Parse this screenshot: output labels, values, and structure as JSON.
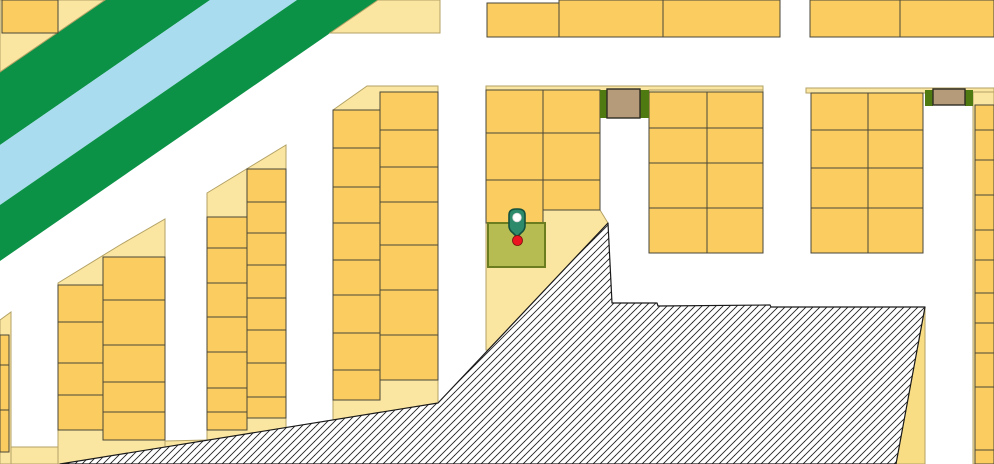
{
  "map": {
    "width": 994,
    "height": 464,
    "palette": {
      "road": "#ffffff",
      "block_cream": "#FBE6A1",
      "block_cream_deep": "#F9DD85",
      "block_stroke": "#B3A266",
      "parcel_fill": "#FBCC5F",
      "parcel_stroke": "#4A4638",
      "river_green": "#0B9247",
      "river_blue": "#A8DCEE",
      "hatch_line": "#222222",
      "hatch_stroke": "#1a1a1a",
      "building_brown": "#B59B79",
      "building_brown_stroke": "#2E2C24",
      "landmark_green": "#4F7A12",
      "selected_fill": "#B6BC52",
      "selected_stroke": "#6B7D1F",
      "pin_fill": "#2D8A6B",
      "pin_stroke": "#14503E",
      "pin_dot_fill": "#ffffff",
      "pin_dot_stroke": "#DADADA",
      "marker_red": "#EC1420",
      "marker_red_stroke": "#7A100F"
    },
    "river_bands": [
      {
        "name": "river-bank-upper",
        "fill": "river_green",
        "points": [
          [
            105,
            0
          ],
          [
            210,
            0
          ],
          [
            0,
            145
          ],
          [
            0,
            72
          ]
        ]
      },
      {
        "name": "river-water",
        "fill": "river_blue",
        "points": [
          [
            210,
            0
          ],
          [
            297,
            0
          ],
          [
            0,
            205
          ],
          [
            0,
            145
          ]
        ]
      },
      {
        "name": "river-bank-lower",
        "fill": "river_green",
        "points": [
          [
            297,
            0
          ],
          [
            378,
            0
          ],
          [
            0,
            261
          ],
          [
            0,
            205
          ]
        ]
      }
    ],
    "blocks": [
      {
        "name": "city-block-topleft",
        "fill": "block_cream",
        "points": [
          [
            0,
            0
          ],
          [
            105,
            0
          ],
          [
            0,
            72
          ]
        ]
      },
      {
        "name": "city-block-topmiddle",
        "fill": "block_cream",
        "points": [
          [
            378,
            0
          ],
          [
            440,
            0
          ],
          [
            440,
            33
          ],
          [
            330,
            33
          ]
        ]
      },
      {
        "name": "city-block-left-sliver",
        "fill": "block_cream",
        "points": [
          [
            0,
            320
          ],
          [
            11,
            312
          ],
          [
            11,
            464
          ],
          [
            0,
            464
          ]
        ]
      },
      {
        "name": "city-block-l2",
        "fill": "block_cream",
        "points": [
          [
            58,
            283
          ],
          [
            120,
            245
          ],
          [
            165,
            219
          ],
          [
            165,
            464
          ],
          [
            58,
            464
          ]
        ]
      },
      {
        "name": "city-block-l3",
        "fill": "block_cream",
        "points": [
          [
            207,
            193
          ],
          [
            286,
            145
          ],
          [
            286,
            464
          ],
          [
            207,
            464
          ]
        ]
      },
      {
        "name": "city-block-l4",
        "fill": "block_cream",
        "points": [
          [
            333,
            110
          ],
          [
            367,
            86
          ],
          [
            438,
            86
          ],
          [
            438,
            464
          ],
          [
            333,
            464
          ]
        ]
      },
      {
        "name": "city-block-center",
        "fill": "block_cream",
        "points": [
          [
            486,
            88
          ],
          [
            600,
            88
          ],
          [
            600,
            210
          ],
          [
            608,
            223
          ],
          [
            488,
            350
          ],
          [
            486,
            350
          ]
        ]
      },
      {
        "name": "city-block-center-strip",
        "fill": "block_cream",
        "points": [
          [
            486,
            86
          ],
          [
            763,
            86
          ],
          [
            763,
            91
          ],
          [
            486,
            91
          ]
        ]
      },
      {
        "name": "city-block-r1",
        "fill": "block_cream",
        "points": [
          [
            649,
            90
          ],
          [
            763,
            90
          ],
          [
            763,
            253
          ],
          [
            649,
            253
          ]
        ]
      },
      {
        "name": "city-block-r2-strip",
        "fill": "block_cream",
        "points": [
          [
            806,
            88
          ],
          [
            994,
            88
          ],
          [
            994,
            93
          ],
          [
            806,
            93
          ]
        ]
      },
      {
        "name": "city-block-r2",
        "fill": "block_cream",
        "points": [
          [
            811,
            93
          ],
          [
            923,
            93
          ],
          [
            923,
            253
          ],
          [
            811,
            253
          ]
        ]
      },
      {
        "name": "city-block-right-strip",
        "fill": "block_cream",
        "points": [
          [
            973,
            92
          ],
          [
            994,
            92
          ],
          [
            994,
            464
          ],
          [
            973,
            464
          ]
        ]
      },
      {
        "name": "city-block-se-wedge",
        "fill": "block_cream_deep",
        "points": [
          [
            925,
            307
          ],
          [
            925,
            464
          ],
          [
            896,
            464
          ]
        ]
      },
      {
        "name": "city-block-bottom-sliver-a",
        "fill": "block_cream",
        "points": [
          [
            11,
            447
          ],
          [
            58,
            447
          ],
          [
            58,
            464
          ],
          [
            11,
            464
          ]
        ]
      },
      {
        "name": "city-block-bottom-sliver-b",
        "fill": "block_cream",
        "points": [
          [
            165,
            441
          ],
          [
            207,
            440
          ],
          [
            165,
            448
          ]
        ]
      }
    ],
    "parcel_columns": [
      {
        "name": "parcel-col-topleft-corner",
        "x": 2,
        "w": 56,
        "rows": [
          [
            0,
            33
          ]
        ]
      },
      {
        "name": "parcel-col-top-1",
        "x": 487,
        "w": 72,
        "rows": [
          [
            3,
            37
          ]
        ]
      },
      {
        "name": "parcel-col-top-2",
        "x": 559,
        "w": 104,
        "rows": [
          [
            0,
            37
          ]
        ]
      },
      {
        "name": "parcel-col-top-3",
        "x": 663,
        "w": 117,
        "rows": [
          [
            0,
            37
          ]
        ]
      },
      {
        "name": "parcel-col-top-4",
        "x": 810,
        "w": 90,
        "rows": [
          [
            0,
            37
          ]
        ]
      },
      {
        "name": "parcel-col-top-5",
        "x": 900,
        "w": 94,
        "rows": [
          [
            0,
            37
          ]
        ]
      },
      {
        "name": "parcel-col-l1",
        "x": 0,
        "w": 9,
        "rows": [
          [
            335,
            365
          ],
          [
            365,
            410
          ],
          [
            410,
            452
          ]
        ]
      },
      {
        "name": "parcel-col-l2a",
        "x": 58,
        "w": 45,
        "rows": [
          [
            285,
            322
          ],
          [
            322,
            363
          ],
          [
            363,
            395
          ],
          [
            395,
            430
          ]
        ]
      },
      {
        "name": "parcel-col-l2b",
        "x": 103,
        "w": 62,
        "rows": [
          [
            257,
            300
          ],
          [
            300,
            345
          ],
          [
            345,
            382
          ],
          [
            382,
            412
          ],
          [
            412,
            440
          ]
        ]
      },
      {
        "name": "parcel-col-l3a",
        "x": 207,
        "w": 40,
        "rows": [
          [
            217,
            248
          ],
          [
            248,
            283
          ],
          [
            283,
            317
          ],
          [
            317,
            352
          ],
          [
            352,
            388
          ],
          [
            388,
            412
          ],
          [
            412,
            430
          ]
        ]
      },
      {
        "name": "parcel-col-l3b",
        "x": 247,
        "w": 39,
        "rows": [
          [
            169,
            202
          ],
          [
            202,
            233
          ],
          [
            233,
            265
          ],
          [
            265,
            298
          ],
          [
            298,
            330
          ],
          [
            330,
            363
          ],
          [
            363,
            397
          ],
          [
            397,
            418
          ]
        ]
      },
      {
        "name": "parcel-col-l4a",
        "x": 333,
        "w": 47,
        "rows": [
          [
            110,
            148
          ],
          [
            148,
            187
          ],
          [
            187,
            223
          ],
          [
            223,
            260
          ],
          [
            260,
            295
          ],
          [
            295,
            333
          ],
          [
            333,
            370
          ],
          [
            370,
            400
          ]
        ]
      },
      {
        "name": "parcel-col-l4b",
        "x": 380,
        "w": 58,
        "rows": [
          [
            92,
            130
          ],
          [
            130,
            167
          ],
          [
            167,
            202
          ],
          [
            202,
            245
          ],
          [
            245,
            290
          ],
          [
            290,
            335
          ],
          [
            335,
            380
          ]
        ]
      },
      {
        "name": "parcel-col-ca",
        "x": 486,
        "w": 57,
        "rows": [
          [
            90,
            133
          ],
          [
            133,
            180
          ],
          [
            180,
            223
          ]
        ]
      },
      {
        "name": "parcel-col-cb",
        "x": 543,
        "w": 57,
        "rows": [
          [
            90,
            133
          ],
          [
            133,
            180
          ],
          [
            180,
            210
          ]
        ]
      },
      {
        "name": "parcel-col-r1a",
        "x": 649,
        "w": 58,
        "rows": [
          [
            92,
            128
          ],
          [
            128,
            163
          ],
          [
            163,
            208
          ],
          [
            208,
            253
          ]
        ]
      },
      {
        "name": "parcel-col-r1b",
        "x": 707,
        "w": 56,
        "rows": [
          [
            92,
            128
          ],
          [
            128,
            163
          ],
          [
            163,
            208
          ],
          [
            208,
            253
          ]
        ]
      },
      {
        "name": "parcel-col-r2a",
        "x": 811,
        "w": 57,
        "rows": [
          [
            93,
            130
          ],
          [
            130,
            168
          ],
          [
            168,
            208
          ],
          [
            208,
            253
          ]
        ]
      },
      {
        "name": "parcel-col-r2b",
        "x": 868,
        "w": 55,
        "rows": [
          [
            93,
            130
          ],
          [
            130,
            168
          ],
          [
            168,
            208
          ],
          [
            208,
            253
          ]
        ]
      },
      {
        "name": "parcel-col-right-edge",
        "x": 975,
        "w": 19,
        "rows": [
          [
            105,
            130
          ],
          [
            130,
            160
          ],
          [
            160,
            195
          ],
          [
            195,
            230
          ],
          [
            230,
            260
          ],
          [
            260,
            293
          ],
          [
            293,
            323
          ],
          [
            323,
            353
          ],
          [
            353,
            387
          ],
          [
            387,
            450
          ],
          [
            450,
            464
          ]
        ]
      }
    ],
    "hatch_area": {
      "name": "hatched-restricted-area",
      "points": [
        [
          608,
          223
        ],
        [
          612,
          303
        ],
        [
          657,
          303
        ],
        [
          658,
          306
        ],
        [
          770,
          305
        ],
        [
          771,
          307
        ],
        [
          925,
          307
        ],
        [
          896,
          464
        ],
        [
          60,
          464
        ],
        [
          438,
          403
        ]
      ]
    },
    "landmarks": {
      "green_strips": [
        {
          "name": "landmark-green-strip",
          "x": 600,
          "y": 90,
          "w": 7,
          "h": 28
        },
        {
          "name": "landmark-green-strip",
          "x": 640,
          "y": 90,
          "w": 9,
          "h": 28
        },
        {
          "name": "landmark-green-strip",
          "x": 925,
          "y": 90,
          "w": 8,
          "h": 16
        },
        {
          "name": "landmark-green-strip",
          "x": 965,
          "y": 90,
          "w": 8,
          "h": 16
        }
      ],
      "brown_buildings": [
        {
          "name": "landmark-building-brown",
          "x": 607,
          "y": 89,
          "w": 33,
          "h": 29
        },
        {
          "name": "landmark-building-brown",
          "x": 933,
          "y": 89,
          "w": 32,
          "h": 16
        }
      ]
    },
    "selected_parcel": {
      "name": "selected-parcel",
      "x": 488,
      "y": 223,
      "w": 57,
      "h": 44
    },
    "marker": {
      "name": "location-marker",
      "pin_path": "M509,215 Q509,209 516,209 L518,209 Q525,209 525,215 L525,226 Q525,230 521,233 L518.5,235.5 Q517,237 515.5,235.5 L513,233 Q509,230 509,226 Z",
      "pin_dot": {
        "cx": 517,
        "cy": 217.5,
        "r": 4.3
      },
      "red_dot": {
        "cx": 517.5,
        "cy": 240.5,
        "r": 5
      }
    }
  }
}
